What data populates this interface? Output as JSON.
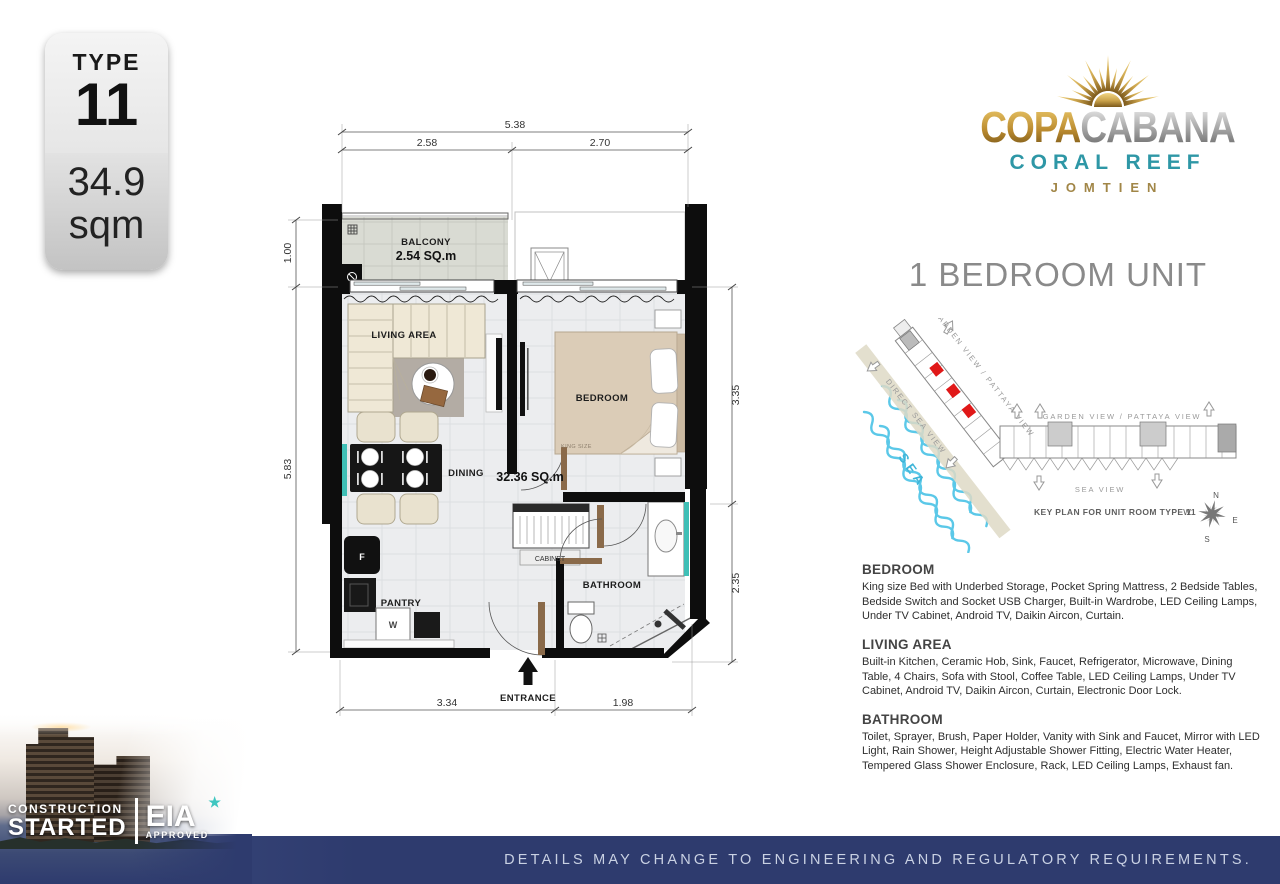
{
  "type_badge": {
    "label": "TYPE",
    "number": "11",
    "area": "34.9",
    "unit": "sqm"
  },
  "logo": {
    "brand_gold": "COPA",
    "brand_silver": "CABANA",
    "subtitle": "CORAL REEF",
    "location": "JOMTIEN"
  },
  "heading": {
    "title": "1 BEDROOM UNIT"
  },
  "key_plan": {
    "direct_sea_view": "DIRECT SEA VIEW",
    "garden_view_diagonal": "GARDEN VIEW / PATTAYA VIEW",
    "garden_view_horizontal": "GARDEN VIEW / PATTAYA VIEW",
    "sea_view": "SEA VIEW",
    "sea": "SEA",
    "caption": "KEY PLAN FOR UNIT ROOM TYPE 11",
    "compass": {
      "n": "N",
      "e": "E",
      "s": "S",
      "w": "W"
    },
    "highlight_color": "#e01818"
  },
  "floor_plan": {
    "labels": {
      "balcony": "BALCONY",
      "balcony_area": "2.54 SQ.m",
      "living_area": "LIVING AREA",
      "bedroom": "BEDROOM",
      "king_size": "KING SIZE",
      "dining": "DINING",
      "unit_area": "32.36 SQ.m",
      "cabinet": "CABINET",
      "bathroom": "BATHROOM",
      "pantry": "PANTRY",
      "fridge": "F",
      "washer": "W",
      "entrance": "ENTRANCE"
    },
    "dimensions": {
      "top_total": "5.38",
      "top_left": "2.58",
      "top_right": "2.70",
      "left_balcony": "1.00",
      "left_main": "5.83",
      "right_bedroom": "3.35",
      "right_bathroom": "2.35",
      "bottom_left": "3.34",
      "bottom_right": "1.98"
    }
  },
  "sections": [
    {
      "heading": "BEDROOM",
      "body": "King size Bed with Underbed Storage, Pocket Spring Mattress, 2 Bedside Tables, Bedside Switch and Socket USB Charger, Built-in Wardrobe, LED Ceiling Lamps, Under TV Cabinet, Android TV, Daikin Aircon, Curtain."
    },
    {
      "heading": "LIVING AREA",
      "body": "Built-in Kitchen, Ceramic Hob, Sink, Faucet, Refrigerator, Microwave, Dining Table, 4 Chairs, Sofa with Stool, Coffee Table, LED Ceiling Lamps, Under TV Cabinet, Android TV, Daikin Aircon, Curtain, Electronic Door Lock."
    },
    {
      "heading": "BATHROOM",
      "body": "Toilet, Sprayer, Brush, Paper Holder, Vanity with Sink and Faucet, Mirror with LED Light, Rain Shower, Height Adjustable Shower Fitting, Electric Water Heater, Tempered Glass Shower Enclosure, Rack, LED Ceiling Lamps, Exhaust fan."
    }
  ],
  "footer": {
    "construction": "CONSTRUCTION",
    "started": "STARTED",
    "eia": "EIA",
    "approved": "APPROVED",
    "disclaimer": "DETAILS MAY CHANGE TO ENGINEERING AND REGULATORY REQUIREMENTS."
  }
}
